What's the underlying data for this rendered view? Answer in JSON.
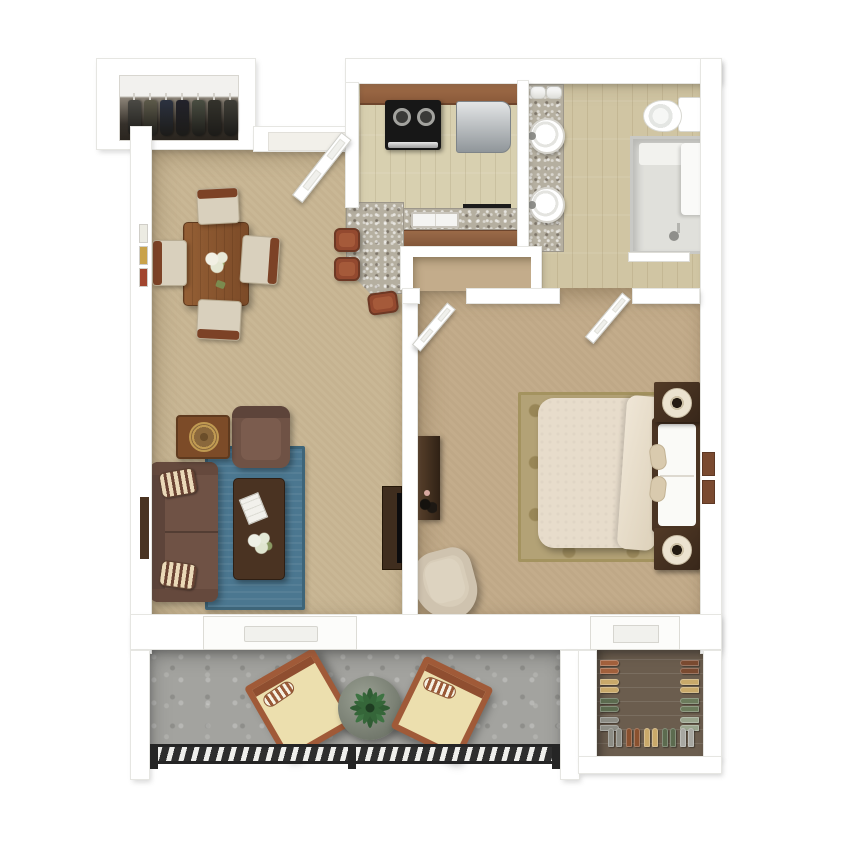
{
  "palette": {
    "outer_background": "#ffffff",
    "wall_white": "#ffffff",
    "wall_edge": "#e6e6e2",
    "carpet_living": "#c9b795",
    "carpet_bedroom": "#c3ac8b",
    "wood_kitchen": "#d8d0b0",
    "wood_bath": "#d0c5a3",
    "granite_counter": "#b5afa0",
    "cabinet_wood": "#9a6a48",
    "appliance_black": "#171717",
    "fridge_steel": "#aeb3b6",
    "rug_blue": "#4b7790",
    "rug_bedroom_tan": "#b3a276",
    "sofa_brown": "#6f5245",
    "dark_wood": "#4a3322",
    "table_wood": "#8a5a33",
    "seat_cream": "#d9d0bd",
    "bed_cream": "#e7dccb",
    "balcony_concrete": "#a3a39f",
    "patio_wood": "#a05a38",
    "patio_cushion": "#ecdfae",
    "railing_dark": "#2e2e2e",
    "closet_floor_brown": "#6b5d4e",
    "plant_green": "#2f5b33"
  },
  "rooms": {
    "entry_closet": {
      "name": "entry coat closet",
      "coat_colors": [
        "#4b4a45",
        "#5d5a4a",
        "#2c3240",
        "#23232b",
        "#4a4e42",
        "#34332c",
        "#3f3e37"
      ]
    },
    "living_dining": {
      "name": "living and dining room",
      "furniture": [
        "dining table with flower centerpiece",
        "four cream dining chairs",
        "brown sofa with striped pillows",
        "brown armchair",
        "end table with round tray",
        "dark wood coffee table with book and flowers",
        "blue area rug",
        "tv console",
        "wall frames",
        "wall art strip"
      ]
    },
    "kitchen": {
      "name": "kitchen",
      "furniture": [
        "upper cabinets",
        "black range with two burners",
        "stainless refrigerator",
        "sink counter",
        "lower cabinets",
        "granite breakfast bar",
        "three bar stools",
        "utensil rail"
      ]
    },
    "bathroom": {
      "name": "bathroom",
      "furniture": [
        "double sink vanity",
        "rolled towels",
        "toilet",
        "walk-in shower with bench"
      ]
    },
    "bedroom": {
      "name": "bedroom",
      "furniture": [
        "bed with cream duvet",
        "headboard with pillows",
        "two nightstands with round lamps",
        "patterned tan rug",
        "dresser",
        "beige accent chair",
        "closet nook",
        "window shutters"
      ]
    },
    "balcony": {
      "name": "balcony",
      "furniture": [
        "two wood patio chairs with cushions",
        "round planter table with green plant",
        "dark slat railing"
      ]
    },
    "shoe_closet": {
      "name": "walk-in shoe closet",
      "left_column": [
        "#a2603c",
        "#c9a96a",
        "#5c6b4f",
        "#8d8d85"
      ],
      "right_column": [
        "#7a4a30",
        "#c9a96a",
        "#6c7b5c",
        "#9aa58e"
      ],
      "bottom_row": [
        "#8d8d85",
        "#8a512f",
        "#c9a96a",
        "#5c6b4f",
        "#a8a8a2"
      ]
    }
  }
}
